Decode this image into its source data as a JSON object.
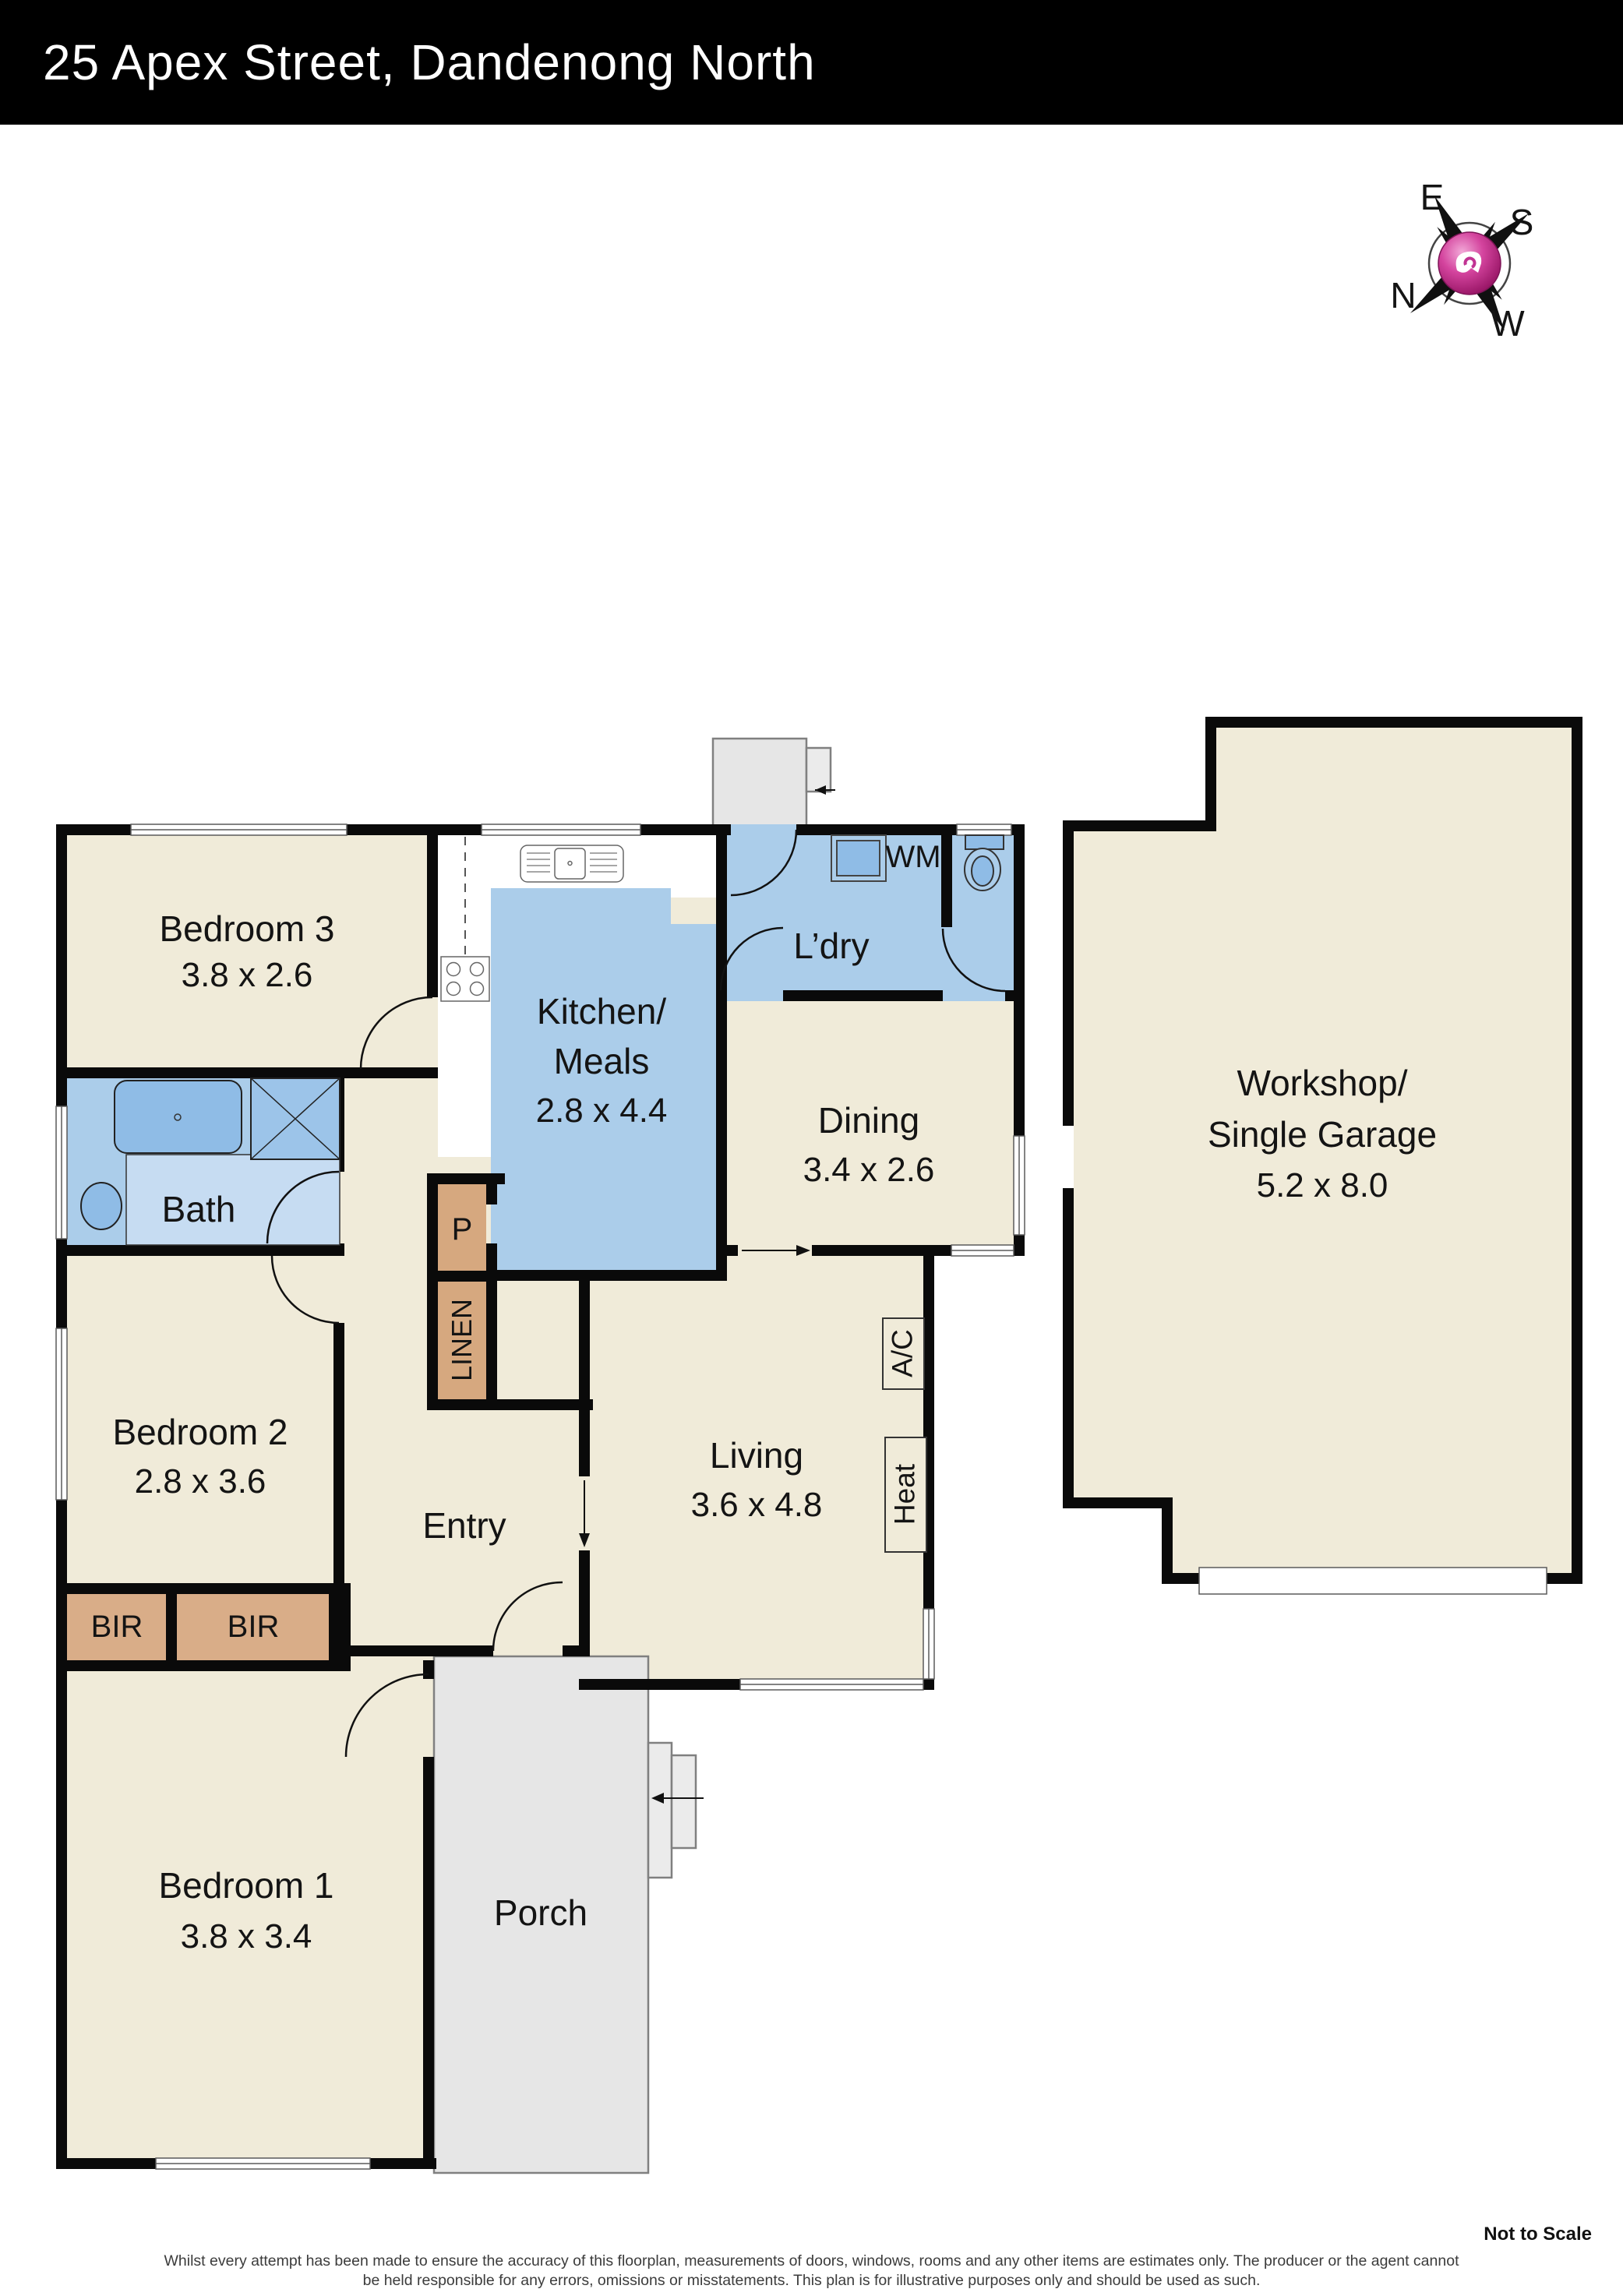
{
  "header": {
    "title": "25 Apex Street, Dandenong North"
  },
  "compass": {
    "n": "N",
    "e": "E",
    "s": "S",
    "w": "W"
  },
  "rooms": {
    "bedroom3": {
      "name": "Bedroom 3",
      "dims": "3.8 x 2.6"
    },
    "kitchen": {
      "name_line1": "Kitchen/",
      "name_line2": "Meals",
      "dims": "2.8 x 4.4"
    },
    "laundry": {
      "name": "L’dry"
    },
    "dining": {
      "name": "Dining",
      "dims": "3.4 x 2.6"
    },
    "bath": {
      "name": "Bath"
    },
    "bedroom2": {
      "name": "Bedroom 2",
      "dims": "2.8 x 3.6"
    },
    "bedroom1": {
      "name": "Bedroom 1",
      "dims": "3.8 x 3.4"
    },
    "living": {
      "name": "Living",
      "dims": "3.6 x 4.8"
    },
    "entry": {
      "name": "Entry"
    },
    "porch": {
      "name": "Porch"
    },
    "workshop": {
      "name_line1": "Workshop/",
      "name_line2": "Single Garage",
      "dims": "5.2 x 8.0"
    }
  },
  "closets": {
    "pantry": "P",
    "linen": "LINEN",
    "bir_left": "BIR",
    "bir_right": "BIR"
  },
  "fixtures": {
    "washing_machine": "WM",
    "air_conditioner": "A/C",
    "heater": "Heat"
  },
  "footer": {
    "scale_note": "Not to Scale",
    "disclaimer_line1": "Whilst every attempt has been made to ensure the accuracy of this floorplan, measurements of doors, windows, rooms and any other items are estimates only. The producer or the agent cannot",
    "disclaimer_line2": "be held responsible for any errors, omissions or misstatements. This plan is for illustrative purposes only and should be used as such."
  },
  "colors": {
    "wall": "#0a0a0a",
    "cream": "#f0ebd9",
    "room_blue": "#abcdea",
    "vanity_blue": "#c6dcf2",
    "fixture_blue": "#8fbce6",
    "shower_blue": "#9cc4e9",
    "tan": "#d6a87f",
    "porch_gray": "#e6e6e6",
    "compass_magenta": "#c13393"
  }
}
